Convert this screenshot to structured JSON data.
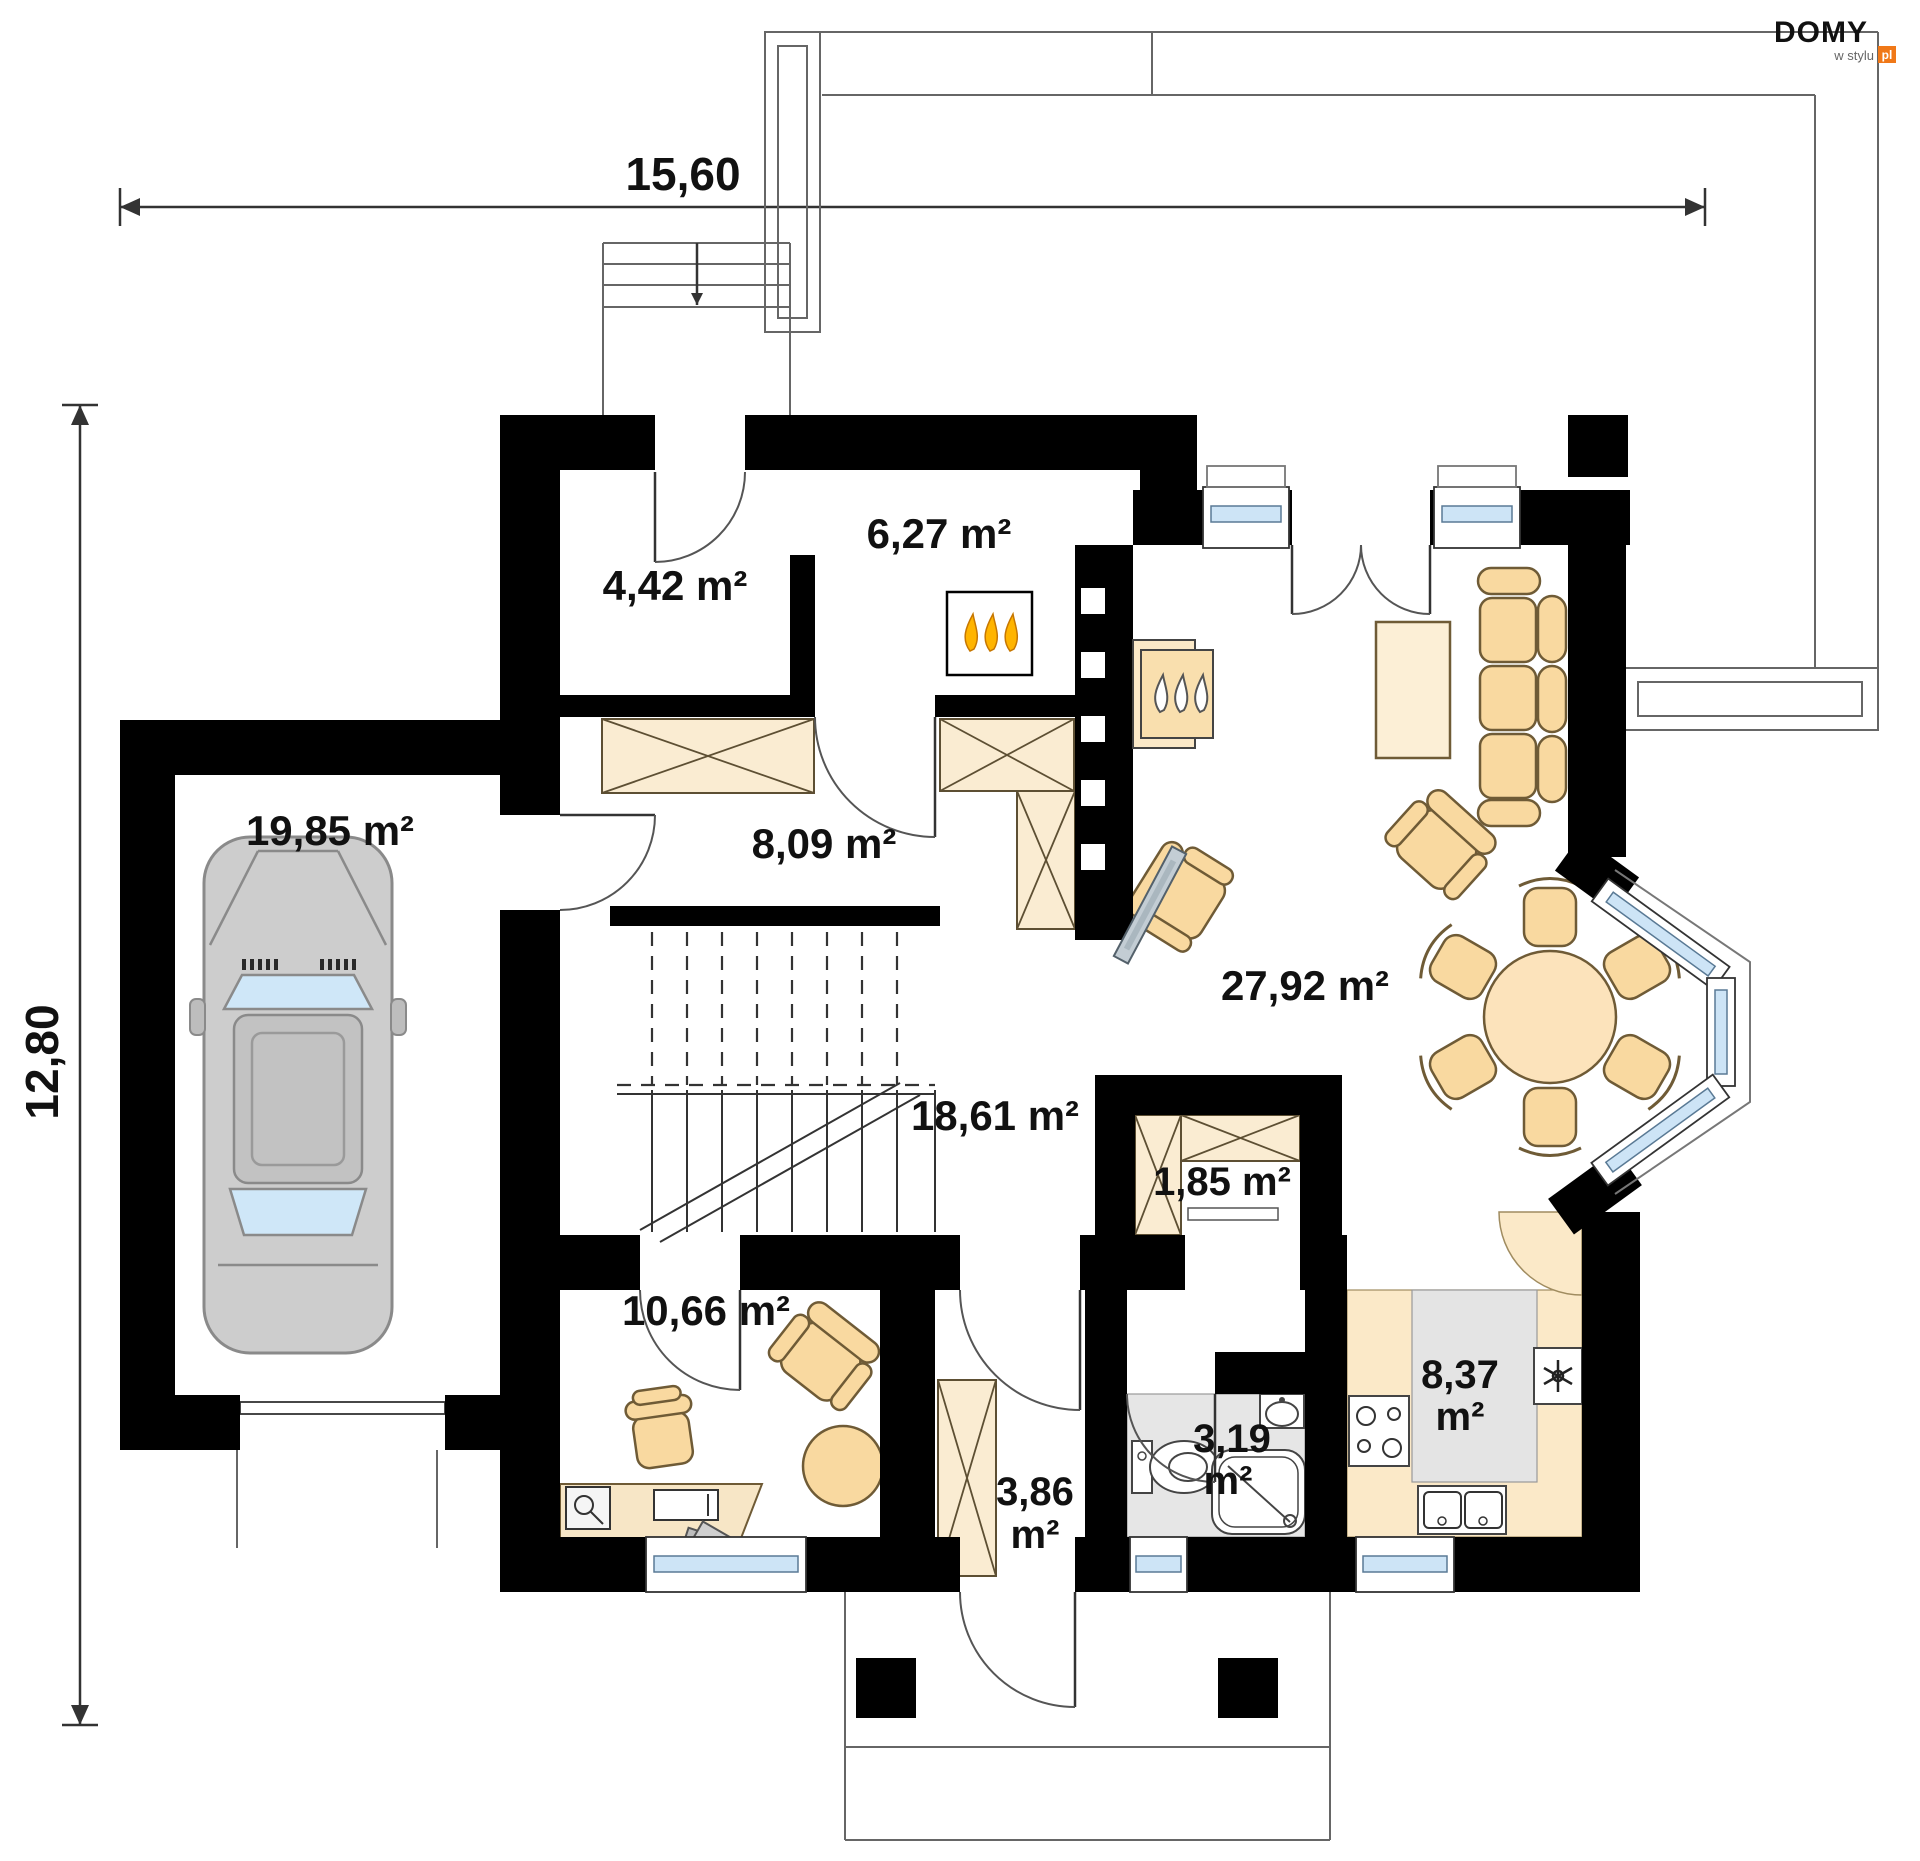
{
  "logo": {
    "brand": "DOMY",
    "tagline": "w stylu",
    "tld": "pl",
    "accent_color": "#f07818"
  },
  "dimensions": {
    "width_label": "15,60",
    "height_label": "12,80"
  },
  "rooms": {
    "garage": {
      "area": "19,85 m²"
    },
    "boiler_room": {
      "area": "4,42 m²"
    },
    "vestibule": {
      "area": "6,27 m²"
    },
    "hall": {
      "area": "8,09 m²"
    },
    "living_room": {
      "area": "27,92 m²"
    },
    "inner_hall": {
      "area": "18,61 m²"
    },
    "pantry": {
      "area": "1,85 m²"
    },
    "office": {
      "area": "10,66 m²"
    },
    "corridor": {
      "area_value": "3,86",
      "area_unit": "m²"
    },
    "bathroom": {
      "area_value": "3,19",
      "area_unit": "m²"
    },
    "kitchen": {
      "area_value": "8,37",
      "area_unit": "m²"
    }
  },
  "colors": {
    "wall": "#000000",
    "furniture": "#f9d9a0",
    "furniture_light": "#faecd2",
    "floor_tile": "#e4e4e4",
    "window_glass": "#cde4f6",
    "flame": "#ffb400"
  }
}
